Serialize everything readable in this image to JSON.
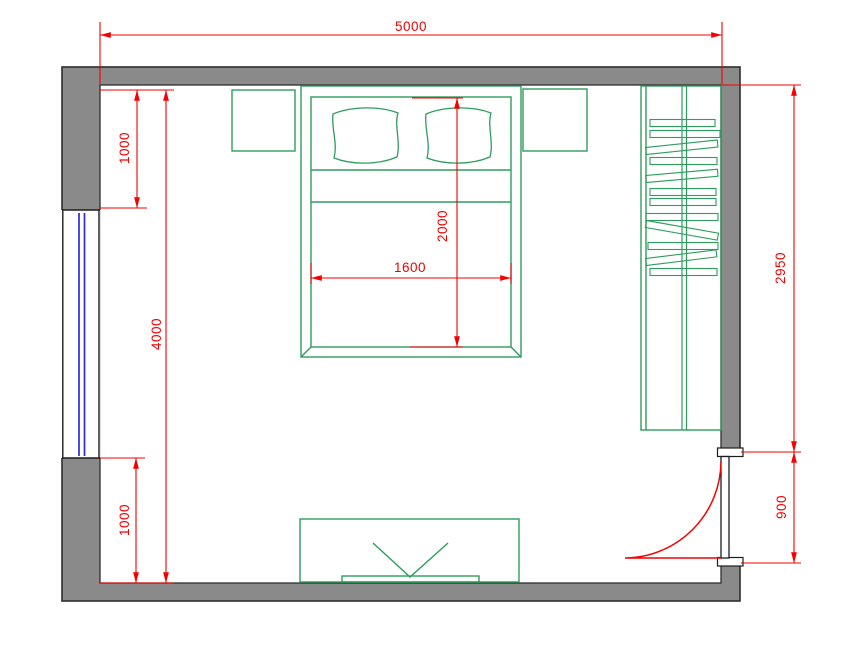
{
  "dims": {
    "room_width_top": "5000",
    "room_height_left": "4000",
    "window_offset_top": "1000",
    "window_offset_bottom": "1000",
    "bed_length": "2000",
    "bed_width": "1600",
    "right_wall_upper": "2950",
    "door_opening": "900"
  },
  "colors": {
    "dimension_red": "#f40000",
    "furniture_green": "#2d9d5e",
    "wall_gray": "#8a8a8a",
    "wall_outline": "#2e2e2e",
    "window_blue": "#2a2ae0",
    "background": "#ffffff"
  },
  "symbols": [
    "double-bed",
    "pillow",
    "pillow",
    "nightstand",
    "nightstand",
    "wardrobe-with-hangers",
    "hanger-rail",
    "tv-stand",
    "tv",
    "window",
    "door-leaf",
    "door-swing-arc"
  ]
}
